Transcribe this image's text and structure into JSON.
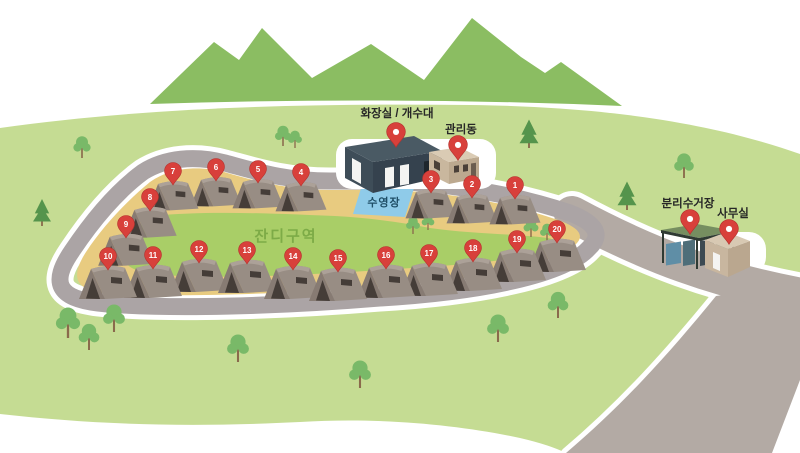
{
  "map": {
    "area_label": "잔디구역",
    "pool_label": "수영장",
    "facilities": [
      {
        "id": "toilet",
        "label": "화장실 / 개수대",
        "label_x": 397,
        "label_y": 117,
        "pin_x": 396,
        "pin_y": 133
      },
      {
        "id": "admin",
        "label": "관리동",
        "label_x": 461,
        "label_y": 133,
        "pin_x": 458,
        "pin_y": 146
      },
      {
        "id": "recycling",
        "label": "분리수거장",
        "label_x": 688,
        "label_y": 207,
        "pin_x": 690,
        "pin_y": 220
      },
      {
        "id": "office",
        "label": "사무실",
        "label_x": 733,
        "label_y": 217,
        "pin_x": 729,
        "pin_y": 230
      }
    ],
    "sites": [
      {
        "number": "1",
        "x": 515,
        "y": 186,
        "s": 0.88
      },
      {
        "number": "2",
        "x": 472,
        "y": 185,
        "s": 0.88
      },
      {
        "number": "3",
        "x": 431,
        "y": 180,
        "s": 0.88
      },
      {
        "number": "4",
        "x": 301,
        "y": 173,
        "s": 0.88
      },
      {
        "number": "5",
        "x": 258,
        "y": 170,
        "s": 0.88
      },
      {
        "number": "6",
        "x": 216,
        "y": 168,
        "s": 0.88
      },
      {
        "number": "7",
        "x": 173,
        "y": 172,
        "s": 0.88
      },
      {
        "number": "8",
        "x": 150,
        "y": 198,
        "s": 0.92
      },
      {
        "number": "9",
        "x": 126,
        "y": 225,
        "s": 0.96
      },
      {
        "number": "10",
        "x": 108,
        "y": 257,
        "s": 1.0
      },
      {
        "number": "11",
        "x": 153,
        "y": 256,
        "s": 1.0
      },
      {
        "number": "12",
        "x": 199,
        "y": 250,
        "s": 1.0
      },
      {
        "number": "13",
        "x": 247,
        "y": 251,
        "s": 1.0
      },
      {
        "number": "14",
        "x": 293,
        "y": 257,
        "s": 1.0
      },
      {
        "number": "15",
        "x": 338,
        "y": 259,
        "s": 1.0
      },
      {
        "number": "16",
        "x": 386,
        "y": 256,
        "s": 1.0
      },
      {
        "number": "17",
        "x": 429,
        "y": 254,
        "s": 1.0
      },
      {
        "number": "18",
        "x": 473,
        "y": 249,
        "s": 1.0
      },
      {
        "number": "19",
        "x": 517,
        "y": 240,
        "s": 1.0
      },
      {
        "number": "20",
        "x": 557,
        "y": 230,
        "s": 1.0
      }
    ],
    "trees": {
      "pine": [
        [
          42,
          226,
          0.9
        ],
        [
          529,
          148,
          0.95
        ],
        [
          627,
          210,
          0.95
        ]
      ],
      "deciduous": [
        [
          82,
          158,
          0.75
        ],
        [
          283,
          146,
          0.7
        ],
        [
          295,
          148,
          0.6
        ],
        [
          68,
          338,
          1.05
        ],
        [
          89,
          350,
          0.9
        ],
        [
          114,
          332,
          0.95
        ],
        [
          238,
          362,
          0.95
        ],
        [
          360,
          388,
          0.95
        ],
        [
          498,
          342,
          0.95
        ],
        [
          558,
          318,
          0.9
        ],
        [
          684,
          178,
          0.85
        ],
        [
          413,
          234,
          0.6
        ],
        [
          428,
          230,
          0.55
        ],
        [
          531,
          237,
          0.65
        ],
        [
          547,
          241,
          0.6
        ]
      ]
    },
    "colors": {
      "hill": "#C5DC93",
      "mountain": "#8BBD62",
      "grass_zone": "#A9CE67",
      "sand": "#E8CB80",
      "road": "#ABA4A5",
      "road_right": "#B3AAA4",
      "pool": "#8FCBE9",
      "pin_red": "#D8403B",
      "pin_dark": "#B5322E",
      "tent_side": "#988D84",
      "tent_front": "#877B73",
      "tent_top": "#ACA198",
      "tent_door": "#453D38",
      "pine_green": "#55944C",
      "leaf_green": "#79B968",
      "trunk": "#8A6A4C"
    }
  }
}
